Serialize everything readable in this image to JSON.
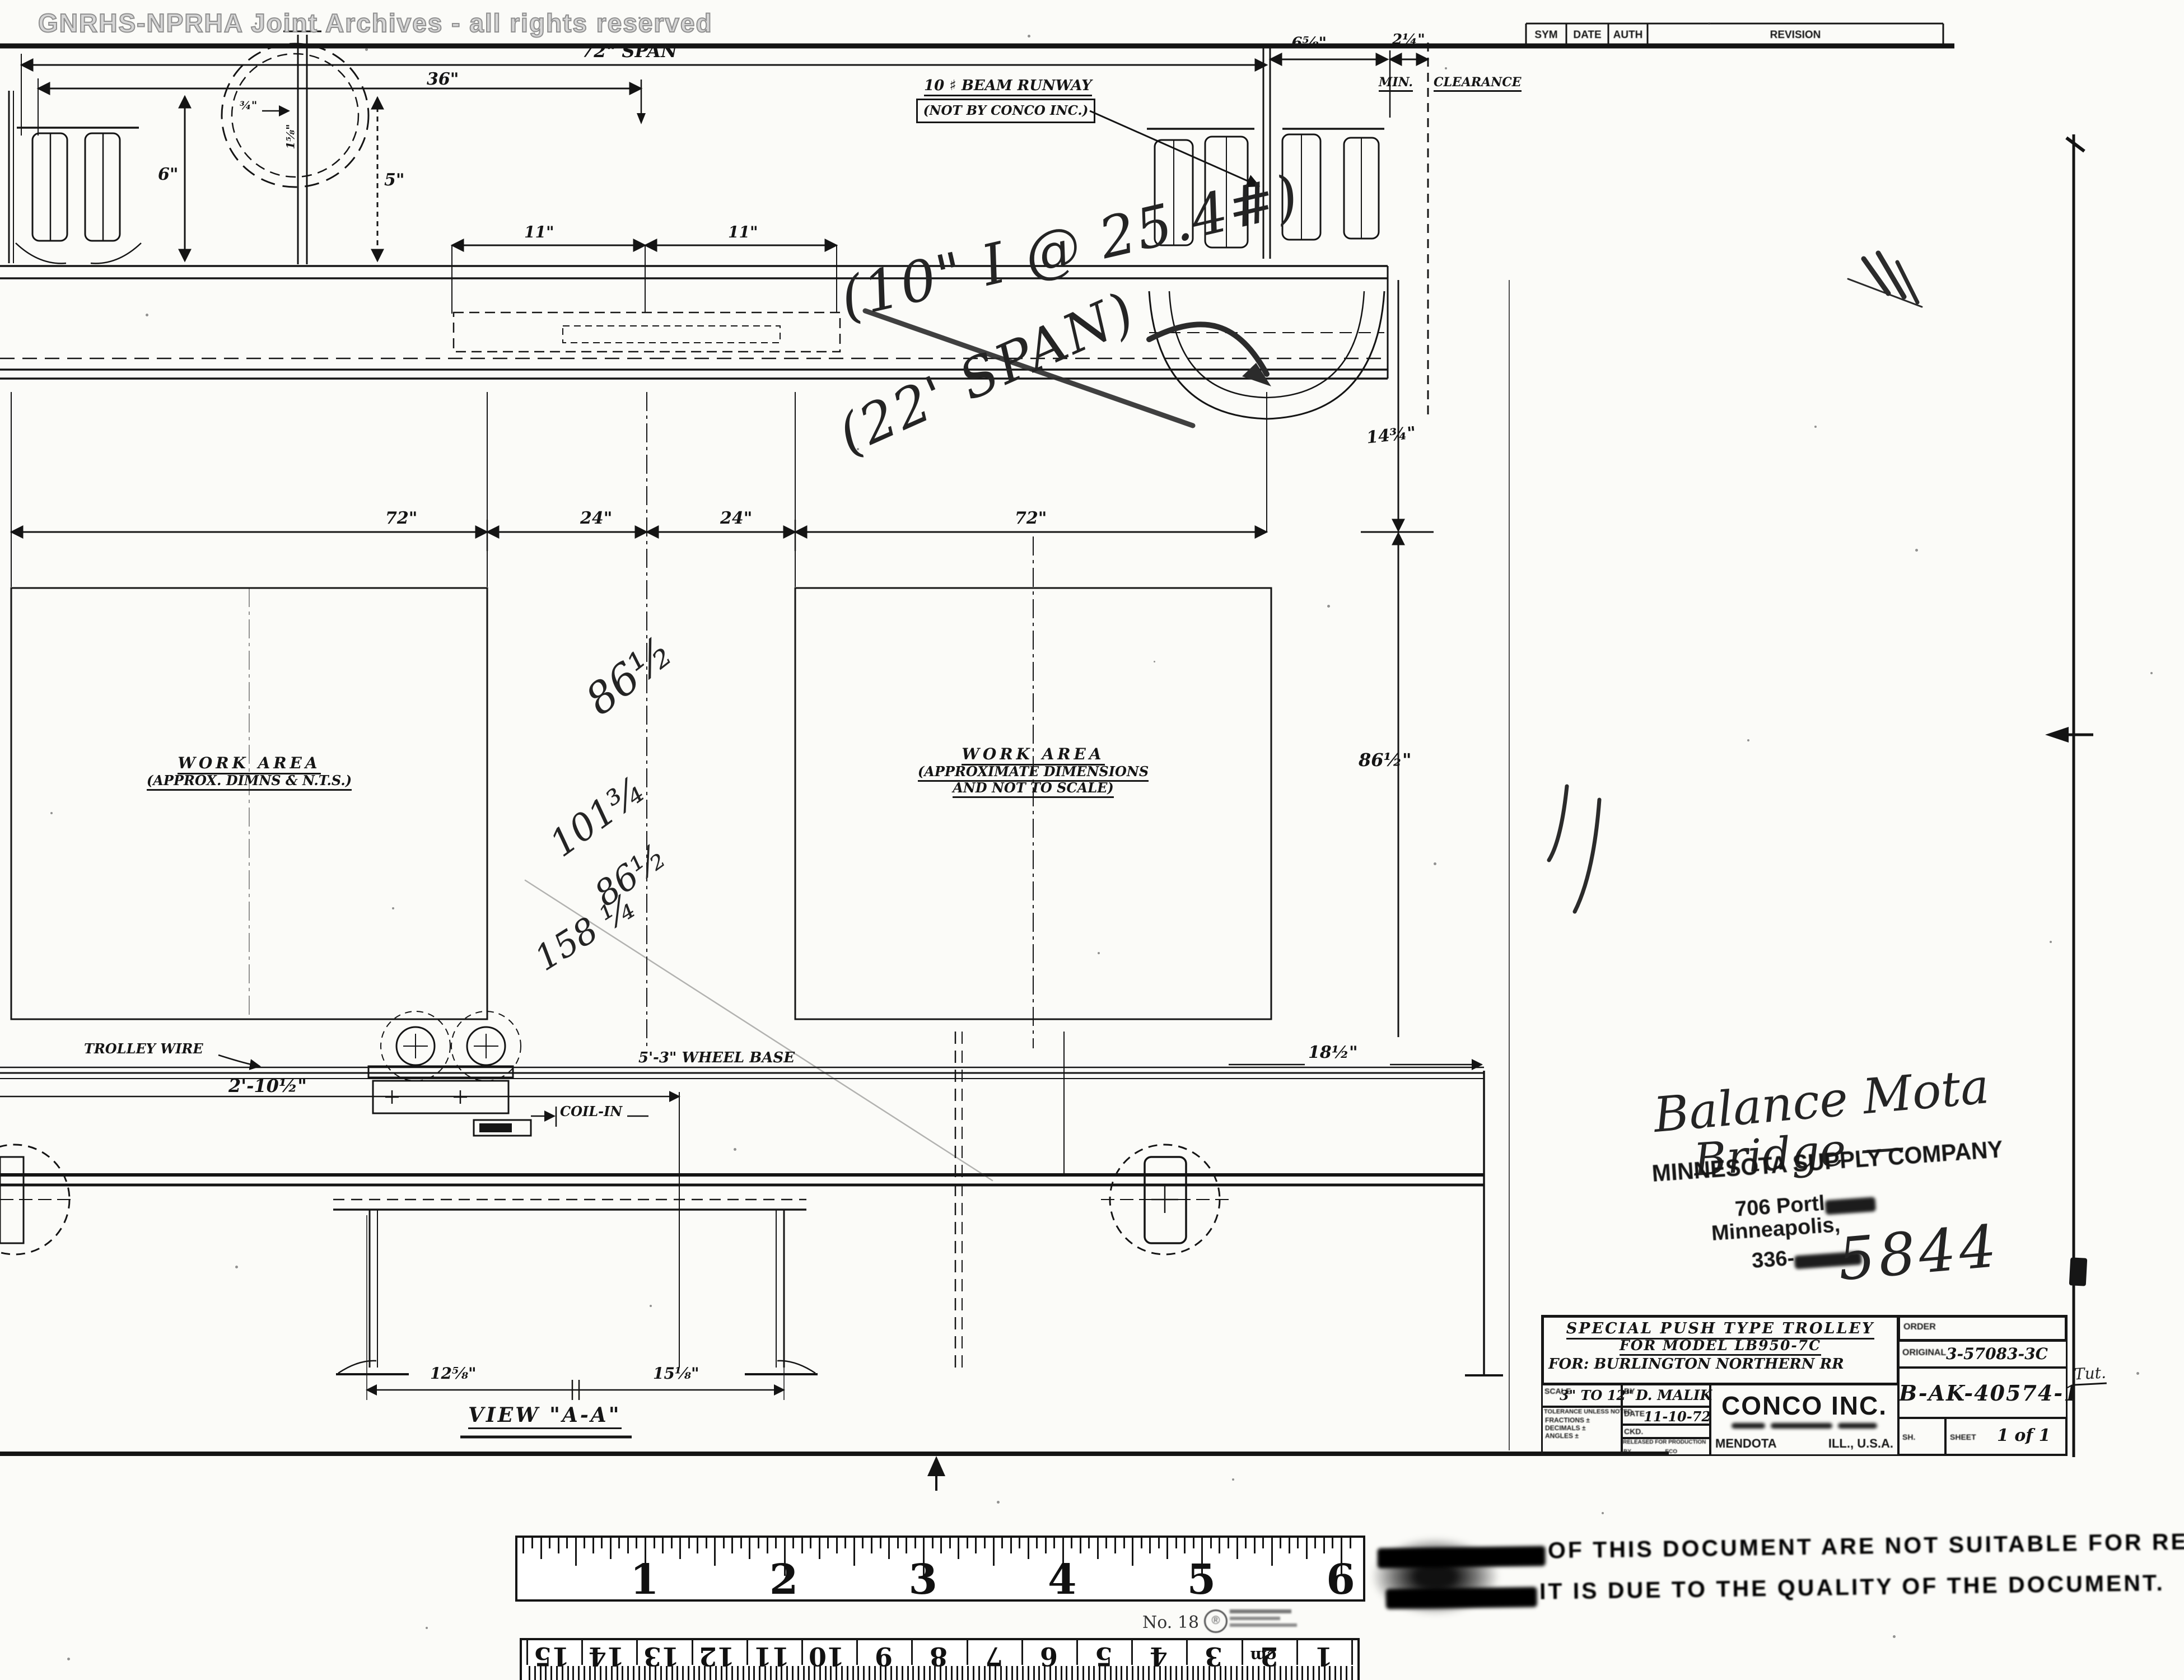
{
  "watermark": "GNRHS-NPRHA Joint Archives - all rights reserved",
  "revision_table": {
    "sym": "SYM",
    "date": "DATE",
    "auth": "AUTH",
    "revision": "REVISION"
  },
  "top_view": {
    "span72": "72\" SPAN",
    "d36": "36\"",
    "d6": "6\"",
    "d5": "5\"",
    "d34": "¾\"",
    "d158": "1⅝\"",
    "d11a": "11\"",
    "d11b": "11\"",
    "d658": "6⅝\"",
    "d214": "2¼\"",
    "min": "MIN.",
    "clearance": "CLEARANCE",
    "d1434": "14¾\"",
    "d8612": "86½\"",
    "runway_line1": "10 ♯ BEAM RUNWAY",
    "runway_line2": "(NOT BY CONCO INC.)",
    "hw_beam": "(10\" I @ 25.4#)",
    "hw_span": "(22' SPAN)"
  },
  "plan_view": {
    "d72L": "72\"",
    "d24a": "24\"",
    "d24b": "24\"",
    "d72R": "72\"",
    "left_label1": "WORK AREA",
    "left_label2": "(APPROX. DIMNS & N.T.S.)",
    "right_label1": "WORK AREA",
    "right_label2": "(APPROXIMATE DIMENSIONS",
    "right_label3": "AND NOT TO SCALE)",
    "pencil": [
      "86½",
      "101¾",
      "86½",
      "158 ¼"
    ]
  },
  "lower_view": {
    "trolley_wire": "TROLLEY WIRE",
    "wheel_base": "5'-3\" WHEEL BASE",
    "d21012": "2'-10½\"",
    "coil_in": "COIL-IN",
    "d1812": "18½\"",
    "d1258": "12⅝\"",
    "d1518": "15⅛\"",
    "view_aa": "VIEW \"A-A\""
  },
  "notes": {
    "hw_line1": "Balance Mota",
    "hw_line2": "Bridge —",
    "stamp_company": "MINNESOTA SUPPLY COMPANY",
    "stamp_addr1": "706 Portl",
    "stamp_addr2": "Minneapolis,",
    "stamp_phone": "336-",
    "hw_number": "5844",
    "margin_note": "Tut."
  },
  "title_block": {
    "title1": "SPECIAL PUSH TYPE TROLLEY",
    "title2": "FOR MODEL LB950-7C",
    "for_line": "FOR: BURLINGTON NORTHERN RR",
    "scale_label": "SCALE",
    "scale_value": "3\" TO 12\"",
    "by_label": "BY",
    "by_value": "D. MALIK",
    "date_label": "DATE",
    "date_value": "11-10-72",
    "ckd_label": "CKD.",
    "tol_header": "TOLERANCE UNLESS NOTED",
    "tol_rows": [
      "FRACTIONS ±",
      "DECIMALS ±",
      "ANGLES ±"
    ],
    "released_label": "RELEASED FOR PRODUCTION",
    "released_by": "BY",
    "released_eco": "ECO",
    "company": "CONCO INC.",
    "city": "MENDOTA",
    "state": "ILL., U.S.A.",
    "order_label": "ORDER",
    "original_label": "ORIGINAL",
    "original_value": "3-57083-3C",
    "dwg_no": "B-AK-40574-1",
    "sh_label": "SH.",
    "sheet_label": "SHEET",
    "sheet_value": "1 of 1"
  },
  "quality_stamp": {
    "line1": "OF THIS DOCUMENT ARE NOT SUITABLE FOR RE-",
    "line2": "IT IS DUE TO THE QUALITY OF THE DOCUMENT."
  },
  "rulers": {
    "inch_numbers": [
      "1",
      "2",
      "3",
      "4",
      "5",
      "6"
    ],
    "ruler_note": "No. 18",
    "cm_numbers": [
      "15",
      "14",
      "13",
      "12",
      "11",
      "10",
      "9",
      "8",
      "7",
      "6",
      "5",
      "4",
      "3",
      "2",
      "1"
    ],
    "cm_unit": "cm"
  }
}
